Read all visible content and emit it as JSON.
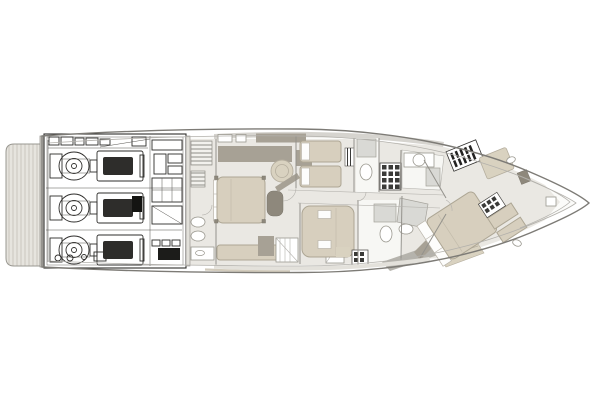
{
  "page": {
    "title": "",
    "background": "#ffffff"
  },
  "palette": {
    "background": "#ffffff",
    "hull_line": "#7d7b76",
    "inner_line": "#b3b1ac",
    "floor": "#eae8e3",
    "room_white": "#f7f7f4",
    "bed_beige": "#d7cfbe",
    "bed_border": "#ada694",
    "furniture_taupe": "#a7a195",
    "furniture_dark": "#8e887c",
    "platform": "#e6e4de",
    "platform_stripe": "#c9c6bf",
    "machinery_line": "#2e2d2b",
    "shower_gray": "#d9d9d5",
    "angled_band": "#b5b3ac",
    "accent_tan": "#d9d2c0",
    "stair_dark": "#3a3a38"
  },
  "plan": {
    "type": "yacht-lower-deck-floorplan",
    "orientation": "bow-right",
    "regions": [
      {
        "id": "swim-platform",
        "label": "Swim platform"
      },
      {
        "id": "engine-room",
        "label": "Engine room"
      },
      {
        "id": "crew-quarters",
        "label": "Crew quarters"
      },
      {
        "id": "midship-cabin",
        "label": "Midship guest cabin"
      },
      {
        "id": "twin-cabin",
        "label": "Twin guest cabin"
      },
      {
        "id": "guest-bathroom",
        "label": "Guest bathroom"
      },
      {
        "id": "staircase",
        "label": "Staircase"
      },
      {
        "id": "forward-bathroom",
        "label": "Forward bathroom"
      },
      {
        "id": "vip-cabin",
        "label": "VIP cabin forward"
      },
      {
        "id": "bow-deck",
        "label": "Bow deck"
      }
    ],
    "engine_count": 3
  }
}
